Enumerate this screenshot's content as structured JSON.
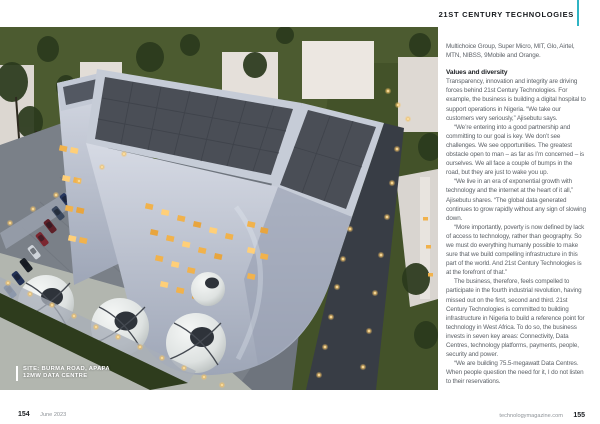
{
  "header": {
    "title": "21ST CENTURY TECHNOLOGIES",
    "accent_color": "#2fb4c4"
  },
  "photo": {
    "caption_line1": "SITE: BURMA ROAD, APAPA",
    "caption_line2": "12MW DATA CENTRE",
    "description": "aerial-dusk-view-of-white-data-centre-building-with-car-park-storage-spheres-and-perimeter-lights"
  },
  "article": {
    "intro": "Multichoice Group, Super Micro, MIT, Glo, Airtel, MTN, NIBSS, 9Mobile and Orange.",
    "heading": "Values and diversity",
    "paragraphs": [
      "Transparency, innovation and integrity are driving forces behind 21st Century Technologies. For example, the business is building a digital hospital to support operations in Nigeria. “We take our customers very seriously,” Ajisebutu says.",
      "“We’re entering into a good partnership and committing to our goal is key. We don’t see challenges. We see opportunities. The greatest obstacle open to man – as far as I’m concerned – is ourselves. We all face a couple of bumps in the road, but they are just to wake you up.",
      "“We live in an era of exponential growth with technology and the internet at the heart of it all,” Ajisebutu shares. “The global data generated continues to grow rapidly without any sign of slowing down.",
      "“More importantly, poverty is now defined by lack of access to technology, rather than geography. So we must do everything humanly possible to make sure that we build compelling infrastructure in this part of the world. And 21st Century Technologies is at the forefront of that.”",
      "The business, therefore, feels compelled to participate in the fourth industrial revolution, having missed out on the first, second and third. 21st Century Technologies is committed to building infrastructure in Nigeria to build a reference point for technology in West Africa. To do so, the business invests in seven key areas: Connectivity, Data Centres, technology platforms, payments, people, security and power.",
      "“We are building 75.5-megawatt Data Centres. When people question the need for it, I do not listen to their reservations."
    ]
  },
  "footer": {
    "left_page": "154",
    "left_date": "June 2023",
    "right_site": "technologymagazine.com",
    "right_page": "155"
  }
}
